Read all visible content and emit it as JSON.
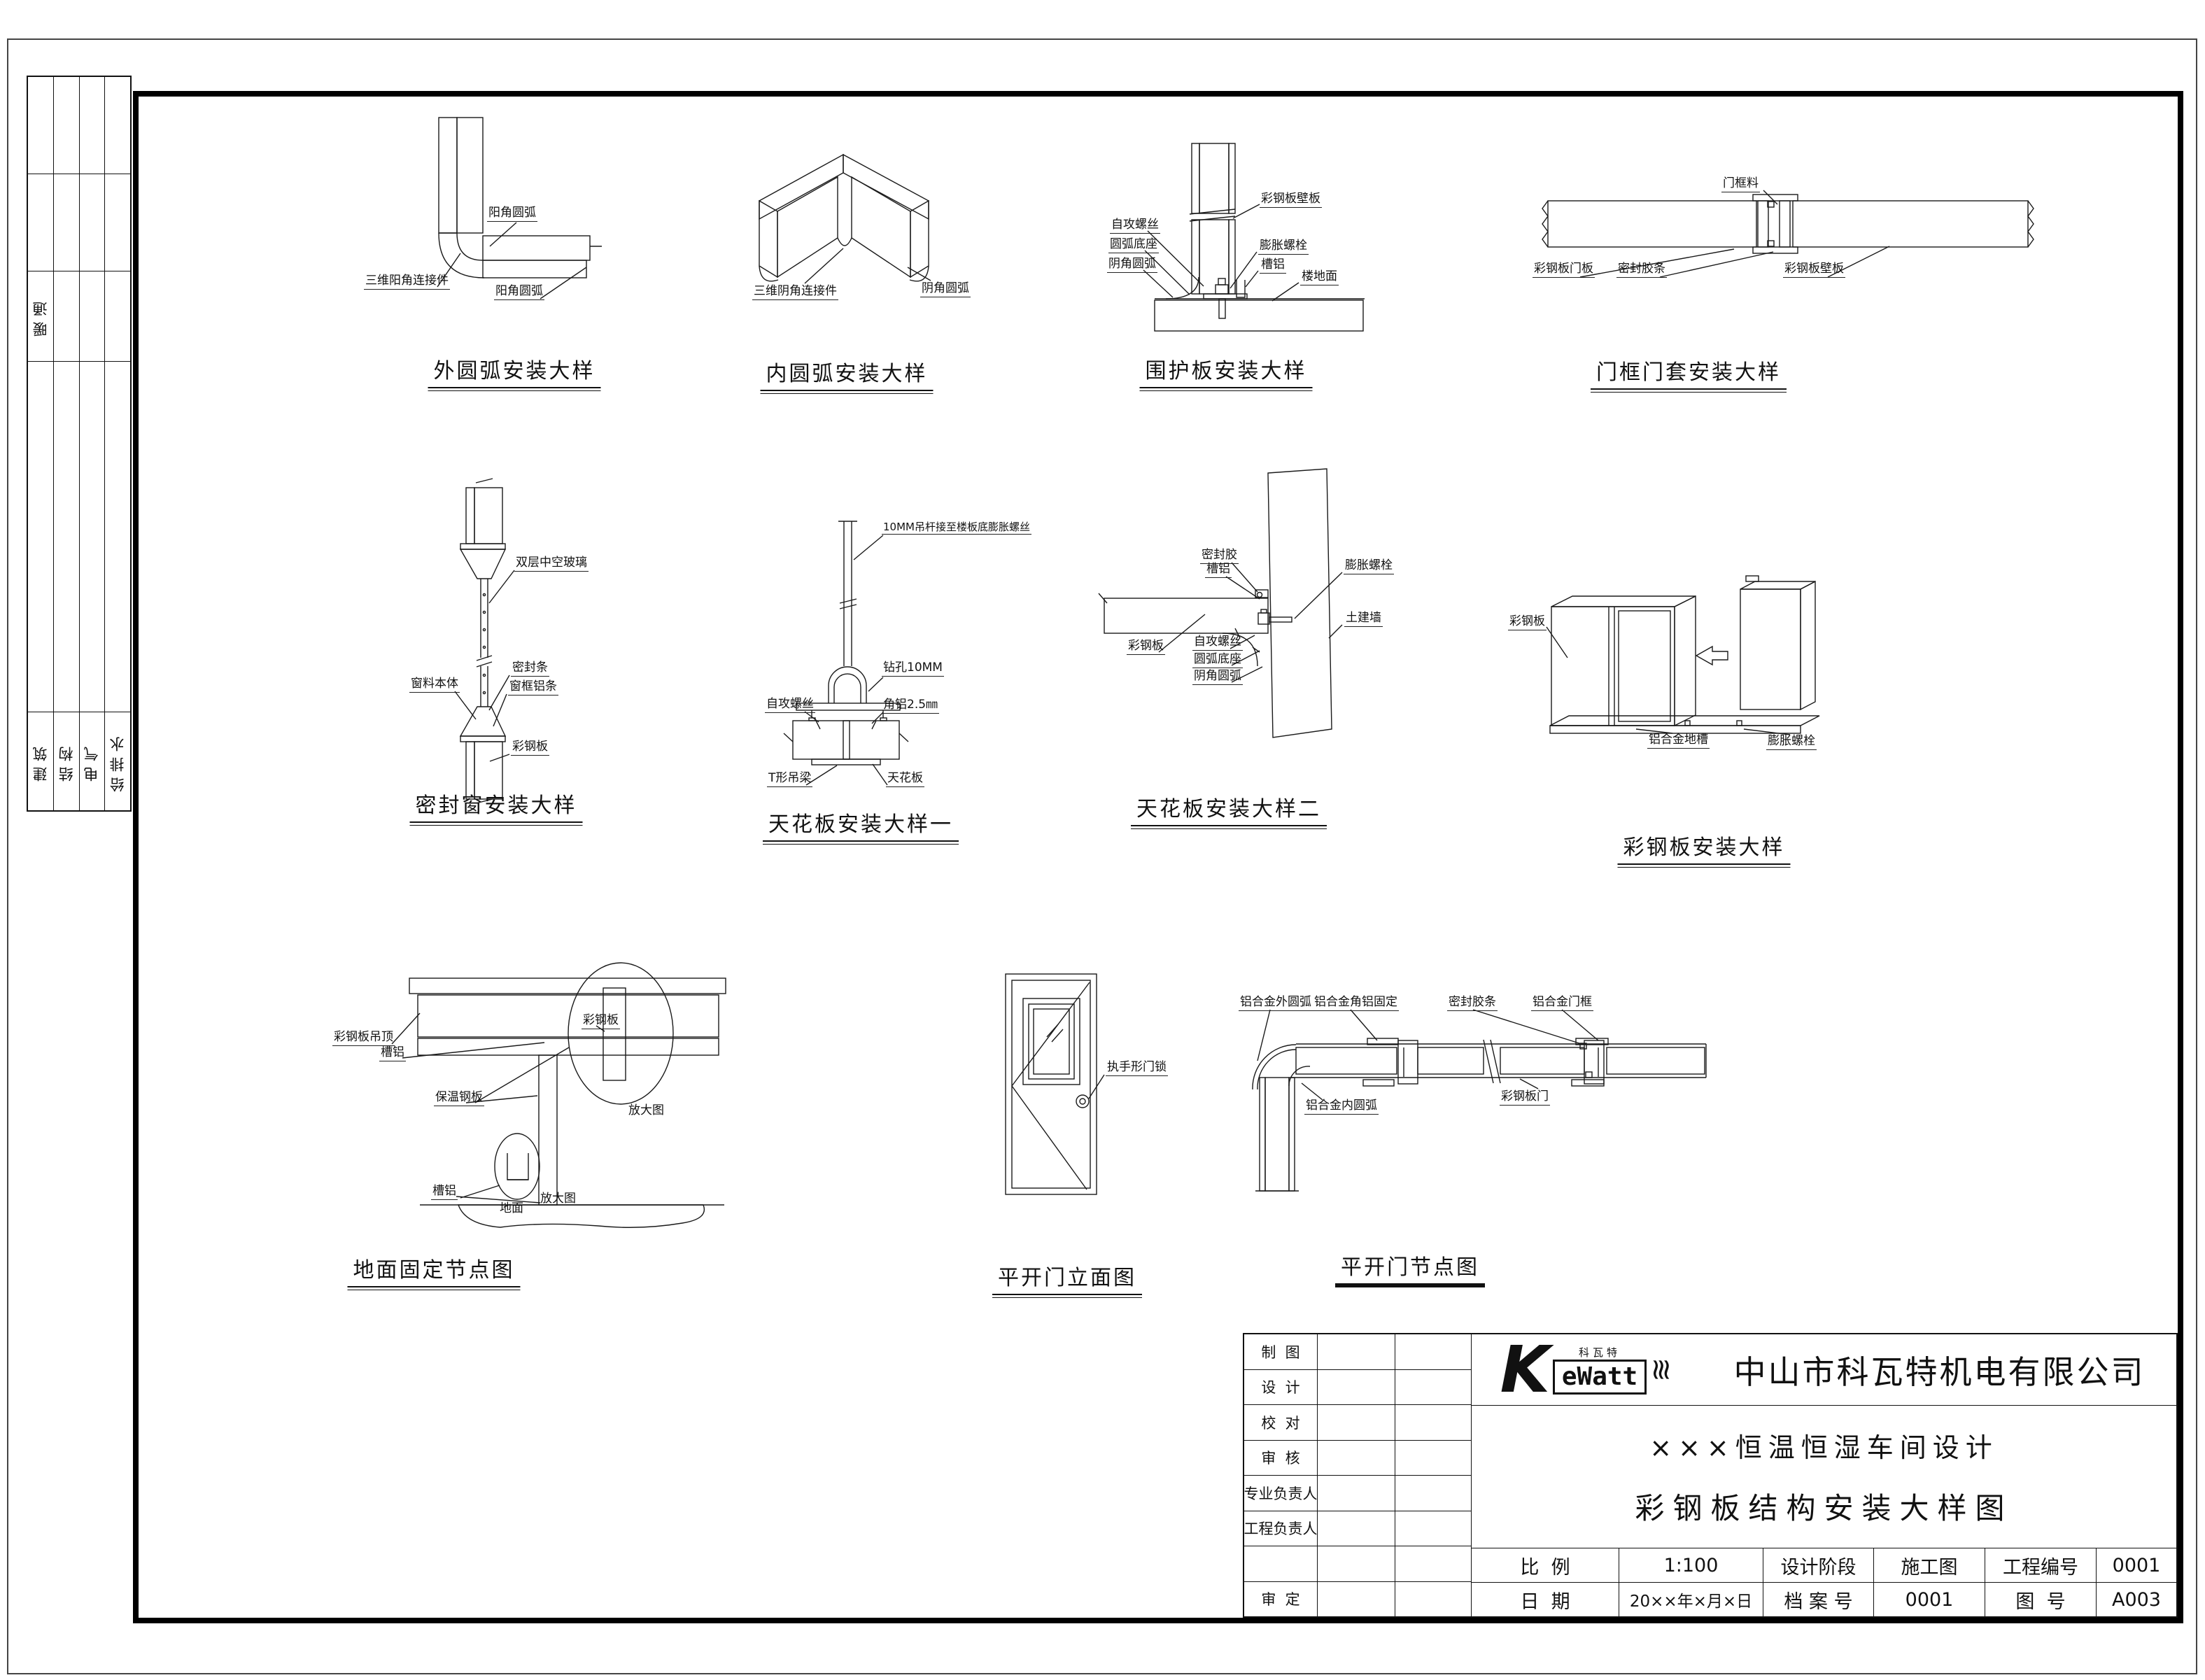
{
  "drawing": {
    "disciplines": {
      "hvac": "暖通",
      "bottom": [
        "建筑",
        "结构",
        "电气",
        "给排水"
      ]
    },
    "details": [
      {
        "title": "外圆弧安装大样",
        "labels": {
          "l1": "阳角圆弧",
          "l2": "三维阳角连接件",
          "l3": "阳角圆弧"
        }
      },
      {
        "title": "内圆弧安装大样",
        "labels": {
          "l1": "三维阴角连接件",
          "l2": "阴角圆弧"
        }
      },
      {
        "title": "围护板安装大样",
        "labels": {
          "l1": "自攻螺丝",
          "l2": "圆弧底座",
          "l3": "阴角圆弧",
          "l4": "彩钢板壁板",
          "l5": "膨胀螺栓",
          "l6": "槽铝",
          "l7": "楼地面"
        }
      },
      {
        "title": "门框门套安装大样",
        "labels": {
          "l1": "门框料",
          "l2": "彩钢板门板",
          "l3": "密封胶条",
          "l4": "彩钢板壁板"
        }
      },
      {
        "title": "密封窗安装大样",
        "labels": {
          "l1": "双层中空玻璃",
          "l2": "密封条",
          "l3": "窗框铝条",
          "l4": "窗料本体",
          "l5": "彩钢板"
        }
      },
      {
        "title": "天花板安装大样一",
        "labels": {
          "l1": "10MM吊杆接至楼板底膨胀螺丝",
          "l2": "钻孔10MM",
          "l3": "自攻螺丝",
          "l4": "角铝2.5㎜",
          "l5": "T形吊梁",
          "l6": "天花板"
        }
      },
      {
        "title": "天花板安装大样二",
        "labels": {
          "l1": "密封胶",
          "l2": "槽铝",
          "l3": "膨胀螺栓",
          "l4": "土建墙",
          "l5": "彩钢板",
          "l6": "自攻螺丝",
          "l7": "圆弧底座",
          "l8": "阴角圆弧"
        }
      },
      {
        "title": "彩钢板安装大样",
        "labels": {
          "l1": "彩钢板",
          "l2": "铝合金地槽",
          "l3": "膨胀螺栓"
        }
      },
      {
        "title": "地面固定节点图",
        "labels": {
          "l1": "彩钢板吊顶",
          "l2": "槽铝",
          "l3": "保温钢板",
          "l4": "彩钢板",
          "l5": "放大图",
          "l6": "槽铝",
          "l7": "地面",
          "l8": "放大图"
        }
      },
      {
        "title": "平开门立面图",
        "labels": {
          "l1": "执手形门锁"
        }
      },
      {
        "title": "平开门节点图",
        "labels": {
          "l1": "铝合金外圆弧",
          "l2": "铝合金角铝固定",
          "l3": "密封胶条",
          "l4": "铝合金门框",
          "l5": "铝合金内圆弧",
          "l6": "彩钢板门"
        }
      }
    ],
    "title_block": {
      "rows": [
        "制  图",
        "设  计",
        "校  对",
        "审  核",
        "专业负责人",
        "工程负责人",
        "",
        "审  定"
      ],
      "logo": {
        "mark": "K",
        "name": "eWatt",
        "cn": "科瓦特",
        "zigzag_icon": "≋"
      },
      "company": "中山市科瓦特机电有限公司",
      "project": "×××恒温恒湿车间设计",
      "drawing_name": "彩钢板结构安装大样图",
      "fields": {
        "scale_label": "比  例",
        "scale": "1:100",
        "stage_label": "设计阶段",
        "stage": "施工图",
        "project_no_label": "工程编号",
        "project_no": "0001",
        "date_label": "日  期",
        "date": "20××年×月×日",
        "archive_label": "档 案 号",
        "archive_no": "0001",
        "drawing_no_label": "图  号",
        "drawing_no": "A003"
      }
    }
  }
}
